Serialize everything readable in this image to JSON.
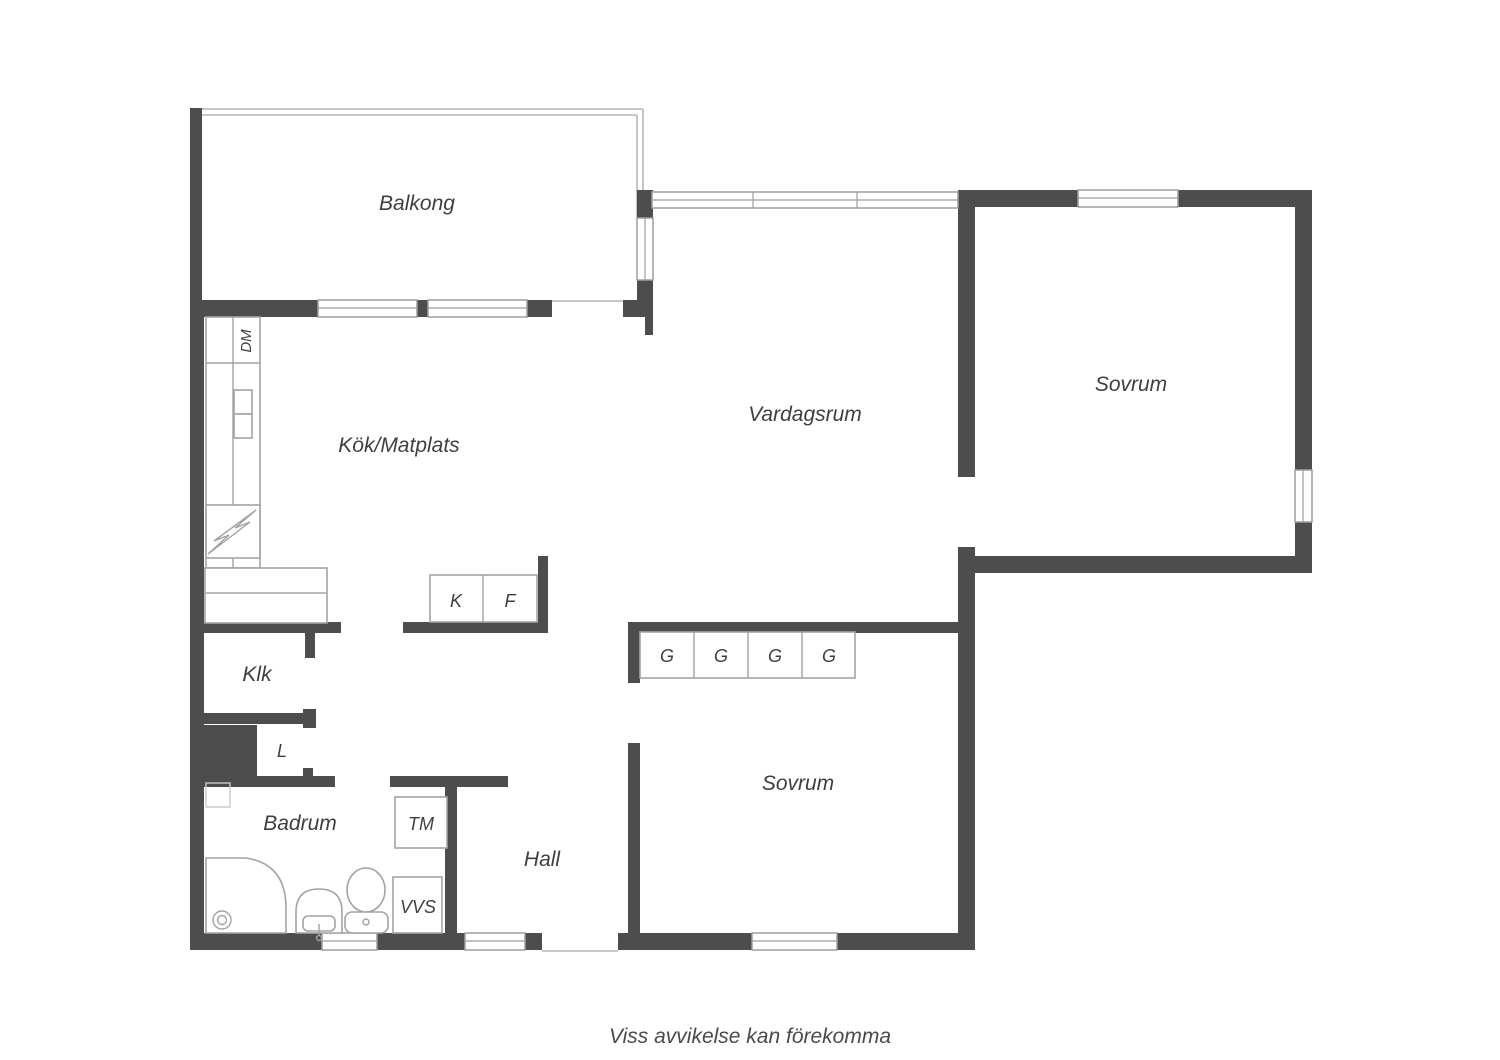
{
  "caption": "Viss avvikelse kan förekomma",
  "colors": {
    "wall": "#4d4d4d",
    "outline": "#a3a3a3",
    "railing": "#b5b5b5",
    "text": "#3f3f3f",
    "background": "#ffffff"
  },
  "rooms": {
    "balcony": {
      "label": "Balkong"
    },
    "kitchen": {
      "label": "Kök/Matplats"
    },
    "living_room": {
      "label": "Vardagsrum"
    },
    "bedroom_upper": {
      "label": "Sovrum"
    },
    "bedroom_lower": {
      "label": "Sovrum"
    },
    "closet": {
      "label": "Klk"
    },
    "linen_closet": {
      "label": "L"
    },
    "bathroom": {
      "label": "Badrum"
    },
    "hall": {
      "label": "Hall"
    }
  },
  "fixtures": {
    "dishwasher": "DM",
    "fridge": "K",
    "freezer": "F",
    "wardrobe": "G",
    "washing_machine": "TM",
    "plumbing": "VVS"
  }
}
